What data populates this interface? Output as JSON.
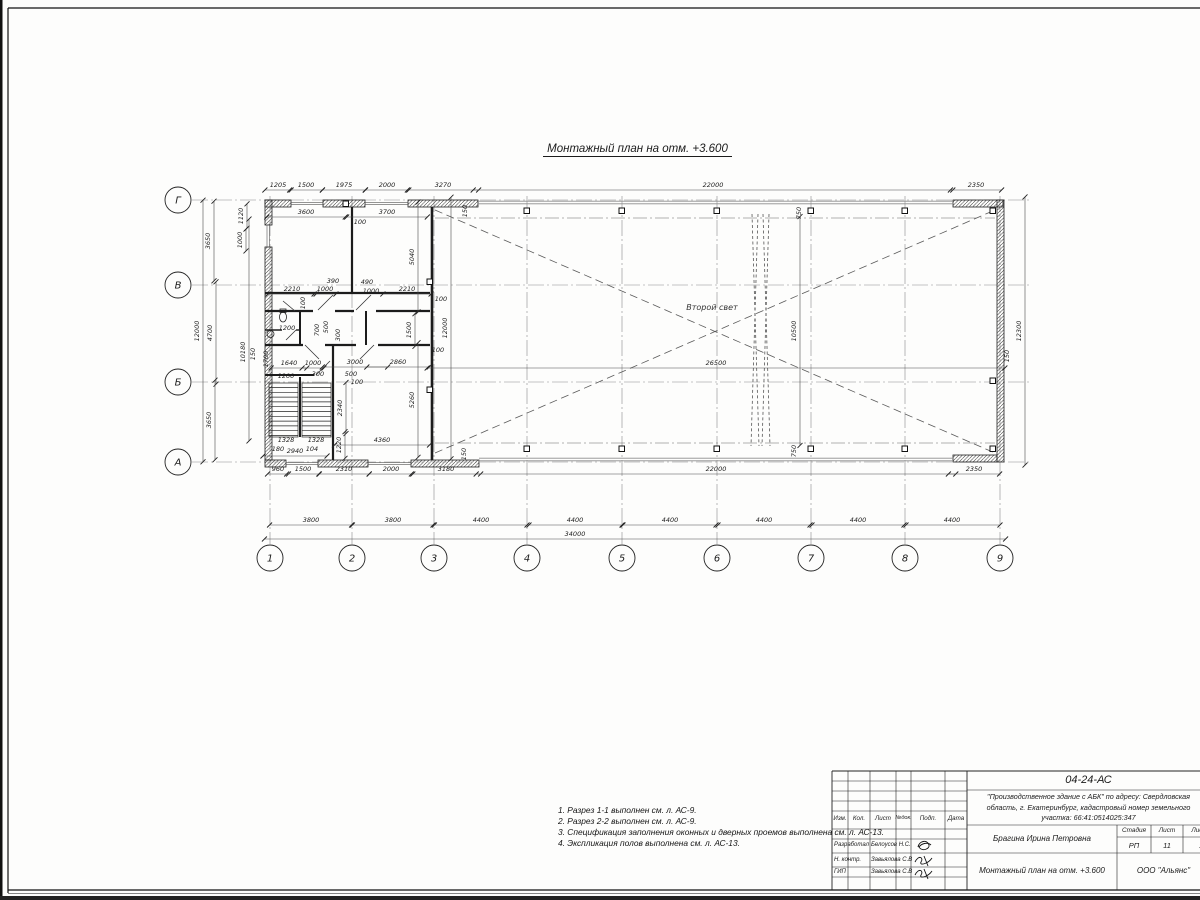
{
  "page": {
    "title": "Монтажный план на отм. +3.600"
  },
  "plan": {
    "hall_label": "Второй свет",
    "axis_cols": [
      "1",
      "2",
      "3",
      "4",
      "5",
      "6",
      "7",
      "8",
      "9"
    ],
    "axis_rows": [
      "Г",
      "В",
      "Б",
      "А"
    ],
    "dims": [
      {
        "t": "1205",
        "x": 278,
        "y": 187
      },
      {
        "t": "1500",
        "x": 306,
        "y": 187
      },
      {
        "t": "1975",
        "x": 344,
        "y": 187
      },
      {
        "t": "2000",
        "x": 387,
        "y": 187
      },
      {
        "t": "3270",
        "x": 443,
        "y": 187
      },
      {
        "t": "22000",
        "x": 713,
        "y": 187
      },
      {
        "t": "2350",
        "x": 976,
        "y": 187
      },
      {
        "t": "3600",
        "x": 306,
        "y": 214
      },
      {
        "t": "3700",
        "x": 387,
        "y": 214
      },
      {
        "t": "150",
        "x": 467,
        "y": 211,
        "v": 1,
        "n": 1
      },
      {
        "t": "100",
        "x": 360,
        "y": 224,
        "n": 1
      },
      {
        "t": "3650",
        "x": 210,
        "y": 241,
        "v": 1
      },
      {
        "t": "4700",
        "x": 212,
        "y": 333,
        "v": 1
      },
      {
        "t": "3650",
        "x": 211,
        "y": 420,
        "v": 1
      },
      {
        "t": "12000",
        "x": 199,
        "y": 331,
        "v": 1
      },
      {
        "t": "1120",
        "x": 243,
        "y": 216,
        "v": 1
      },
      {
        "t": "1000",
        "x": 242,
        "y": 240,
        "v": 1
      },
      {
        "t": "10180",
        "x": 245,
        "y": 352,
        "v": 1,
        "c": 330
      },
      {
        "t": "150",
        "x": 255,
        "y": 354,
        "v": 1,
        "n": 1
      },
      {
        "t": "1700",
        "x": 268,
        "y": 359,
        "v": 1,
        "n": 1
      },
      {
        "t": "2210",
        "x": 292,
        "y": 291
      },
      {
        "t": "1000",
        "x": 325,
        "y": 291
      },
      {
        "t": "390",
        "x": 333,
        "y": 283,
        "n": 1
      },
      {
        "t": "490",
        "x": 367,
        "y": 284,
        "n": 1
      },
      {
        "t": "1000",
        "x": 371,
        "y": 293,
        "n": 1
      },
      {
        "t": "2210",
        "x": 407,
        "y": 291
      },
      {
        "t": "100",
        "x": 305,
        "y": 303,
        "v": 1,
        "n": 1
      },
      {
        "t": "100",
        "x": 441,
        "y": 301,
        "n": 1
      },
      {
        "t": "5040",
        "x": 414,
        "y": 257,
        "v": 1
      },
      {
        "t": "1200",
        "x": 287,
        "y": 330,
        "n": 1
      },
      {
        "t": "700",
        "x": 319,
        "y": 330,
        "v": 1,
        "n": 1
      },
      {
        "t": "500",
        "x": 328,
        "y": 327,
        "v": 1,
        "n": 1
      },
      {
        "t": "300",
        "x": 340,
        "y": 335,
        "v": 1,
        "n": 1
      },
      {
        "t": "1640",
        "x": 289,
        "y": 365
      },
      {
        "t": "1000",
        "x": 313,
        "y": 365
      },
      {
        "t": "3000",
        "x": 355,
        "y": 364
      },
      {
        "t": "2860",
        "x": 398,
        "y": 364
      },
      {
        "t": "1500",
        "x": 411,
        "y": 330,
        "v": 1
      },
      {
        "t": "100",
        "x": 438,
        "y": 352,
        "n": 1
      },
      {
        "t": "12000",
        "x": 447,
        "y": 328,
        "v": 1
      },
      {
        "t": "1200",
        "x": 286,
        "y": 378,
        "n": 1
      },
      {
        "t": "300",
        "x": 318,
        "y": 376,
        "n": 1
      },
      {
        "t": "500",
        "x": 351,
        "y": 376,
        "n": 1
      },
      {
        "t": "100",
        "x": 357,
        "y": 384,
        "n": 1
      },
      {
        "t": "2340",
        "x": 342,
        "y": 408,
        "v": 1
      },
      {
        "t": "5260",
        "x": 414,
        "y": 400,
        "v": 1
      },
      {
        "t": "1328",
        "x": 286,
        "y": 442,
        "n": 1
      },
      {
        "t": "1328",
        "x": 316,
        "y": 442,
        "n": 1
      },
      {
        "t": "180",
        "x": 278,
        "y": 451,
        "n": 1
      },
      {
        "t": "2940",
        "x": 295,
        "y": 453
      },
      {
        "t": "104",
        "x": 312,
        "y": 451,
        "n": 1
      },
      {
        "t": "1220",
        "x": 341,
        "y": 445,
        "v": 1
      },
      {
        "t": "4360",
        "x": 382,
        "y": 442
      },
      {
        "t": "150",
        "x": 466,
        "y": 454,
        "v": 1,
        "n": 1
      },
      {
        "t": "960",
        "x": 278,
        "y": 471
      },
      {
        "t": "1500",
        "x": 303,
        "y": 471
      },
      {
        "t": "2310",
        "x": 344,
        "y": 471
      },
      {
        "t": "2000",
        "x": 391,
        "y": 471
      },
      {
        "t": "3180",
        "x": 446,
        "y": 471
      },
      {
        "t": "22000",
        "x": 716,
        "y": 471
      },
      {
        "t": "2350",
        "x": 974,
        "y": 471
      },
      {
        "t": "3800",
        "x": 311,
        "y": 522
      },
      {
        "t": "3800",
        "x": 393,
        "y": 522
      },
      {
        "t": "4400",
        "x": 481,
        "y": 522
      },
      {
        "t": "4400",
        "x": 575,
        "y": 522
      },
      {
        "t": "4400",
        "x": 670,
        "y": 522
      },
      {
        "t": "4400",
        "x": 764,
        "y": 522
      },
      {
        "t": "4400",
        "x": 858,
        "y": 522
      },
      {
        "t": "4400",
        "x": 952,
        "y": 522
      },
      {
        "t": "34000",
        "x": 575,
        "y": 536,
        "c": 635
      },
      {
        "t": "26500",
        "x": 716,
        "y": 365
      },
      {
        "t": "10500",
        "x": 796,
        "y": 331,
        "v": 1
      },
      {
        "t": "750",
        "x": 801,
        "y": 213,
        "v": 1,
        "n": 1
      },
      {
        "t": "750",
        "x": 796,
        "y": 451,
        "v": 1,
        "n": 1
      },
      {
        "t": "12300",
        "x": 1021,
        "y": 331,
        "v": 1
      },
      {
        "t": "150",
        "x": 1009,
        "y": 356,
        "v": 1,
        "n": 1
      }
    ]
  },
  "notes": {
    "items": [
      "1. Разрез 1-1 выполнен см. л. АС-9.",
      "2. Разрез 2-2 выполнен см. л. АС-9.",
      "3. Спецификация заполнения оконных и дверных проемов выполнена см. л. АС-13.",
      "4. Экспликация полов выполнена см. л. АС-13."
    ]
  },
  "titleblock": {
    "doc_number": "04-24-АС",
    "project_line1": "\"Производственное здание с АБК\" по адресу: Свердловская",
    "project_line2": "область, г. Екатеринбург, кадастровый номер земельного",
    "project_line3": "участка: 66:41:0514025:347",
    "col_izm": "Изм.",
    "col_kol": "Кол.",
    "col_list": "Лист",
    "col_ndok": "№док.",
    "col_podp": "Подп.",
    "col_data": "Дата",
    "row1_role": "Разработал",
    "row1_name": "Белоусов Н.С.",
    "row2_role": "Н. контр.",
    "row2_name": "Завьялова С.В",
    "row3_role": "ГИП",
    "row3_name": "Завьялова С.В",
    "author": "Брагина Ирина Петровна",
    "stage_label": "Стадия",
    "sheet_label": "Лист",
    "sheets_label": "Листов",
    "stage": "РП",
    "sheet": "11",
    "sheets": "13",
    "drawing_title": "Монтажный план на отм. +3.600",
    "company": "ООО \"Альянс\""
  }
}
